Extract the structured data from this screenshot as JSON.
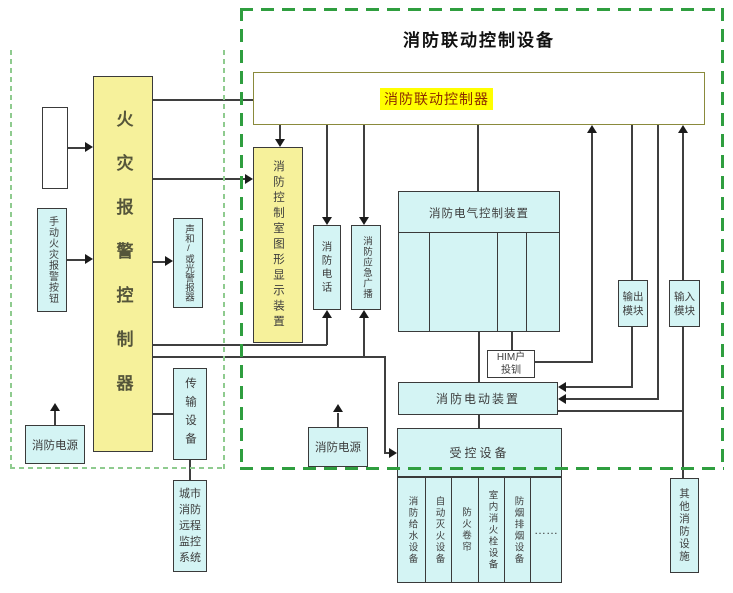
{
  "left_panel": {
    "manual_button": "手动火灾报警按钮",
    "fire_alarm_controller": "火灾报警控制器",
    "sounder": "声和/或光警报器",
    "transmission": "传输设备",
    "city_monitoring": "城市消防远程监控系统",
    "fire_power": "消防电源"
  },
  "right_panel": {
    "title": "消防联动控制设备",
    "linkage_controller": "消防联动控制器",
    "graphic_display": "消防控制室图形显示装置",
    "fire_phone": "消防电话",
    "emergency_broadcast": "消防应急广播",
    "electric_control": "消防电气控制装置",
    "him": {
      "line1": "HIM户",
      "line2": "投钏"
    },
    "fire_power": "消防电源",
    "electric_device": "消防电动装置",
    "controlled_equipment": "受控设备",
    "controlled_items": [
      "消防给水设备",
      "自动灭火设备",
      "防火卷帘",
      "室内消火栓设备",
      "防烟排烟设备",
      "……"
    ],
    "output_module": "输出模块",
    "input_module": "输入模块",
    "other_facilities": "其他消防设施"
  },
  "colors": {
    "box_yellow": "#f6f19b",
    "box_cyan": "#d4f4f4",
    "highlight_yellow": "#ffff00",
    "label_red": "#8b2a00",
    "dash_green_dark": "#2f9e3f",
    "dash_green_light": "#8fcb8f",
    "line_gray": "#3f3f3f"
  }
}
